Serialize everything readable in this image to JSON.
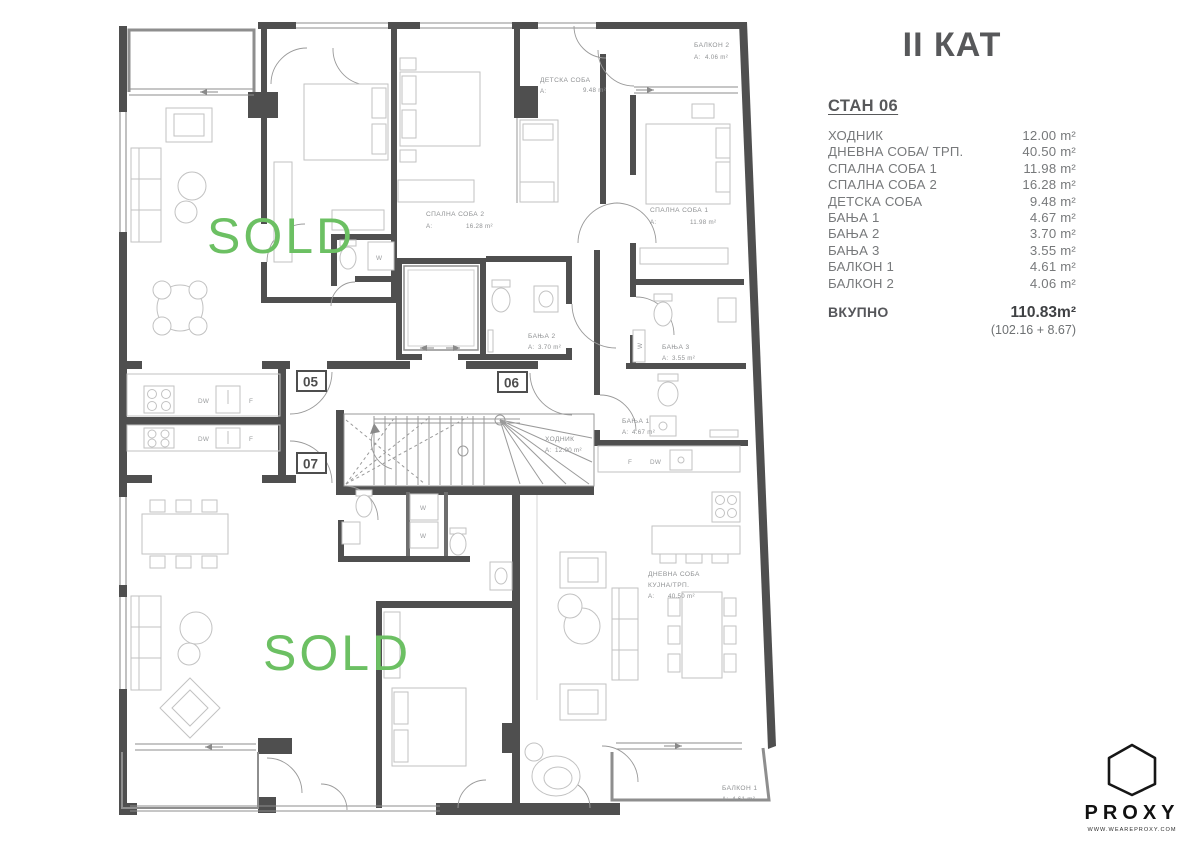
{
  "panel": {
    "floor_title": "II КАТ",
    "apartment_title": "СТАН 06",
    "rooms": [
      {
        "label": "ХОДНИК",
        "value": "12.00 m²"
      },
      {
        "label": "ДНЕВНА СОБА/ ТРП.",
        "value": "40.50 m²"
      },
      {
        "label": "СПАЛНА СОБА 1",
        "value": "11.98 m²"
      },
      {
        "label": "СПАЛНА СОБА 2",
        "value": "16.28 m²"
      },
      {
        "label": "ДЕТСКА СОБА",
        "value": "9.48 m²"
      },
      {
        "label": "БАЊА 1",
        "value": "4.67 m²"
      },
      {
        "label": "БАЊА 2",
        "value": "3.70 m²"
      },
      {
        "label": "БАЊА 3",
        "value": "3.55 m²"
      },
      {
        "label": "БАЛКОН 1",
        "value": "4.61 m²"
      },
      {
        "label": "БАЛКОН 2",
        "value": "4.06 m²"
      }
    ],
    "total_label": "ВКУПНО",
    "total_value": "110.83m²",
    "total_note": "(102.16 + 8.67)"
  },
  "plan": {
    "sold": "SOLD",
    "units": {
      "u05": "05",
      "u06": "06",
      "u07": "07"
    },
    "labels": [
      {
        "name": "БАЛКОН 2",
        "a": "A:",
        "value": "4.06 m²"
      },
      {
        "name": "ДЕТСКА СОБА",
        "a": "A:",
        "value": "9.48 m²"
      },
      {
        "name": "СПАЛНА СОБА 2",
        "a": "A:",
        "value": "16.28 m²"
      },
      {
        "name": "СПАЛНА СОБА 1",
        "a": "A:",
        "value": "11.98 m²"
      },
      {
        "name": "БАЊА 2",
        "a": "A:",
        "value": "3.70 m²"
      },
      {
        "name": "БАЊА 3",
        "a": "A:",
        "value": "3.55 m²"
      },
      {
        "name": "БАЊА 1",
        "a": "A:",
        "value": "4.67 m²"
      },
      {
        "name": "ХОДНИК",
        "a": "A:",
        "value": "12.00 m²"
      },
      {
        "name": "ДНЕВНА СОБА",
        "name2": "КУЈНА/ТРП.",
        "a": "A:",
        "value": "40.50 m²"
      },
      {
        "name": "БАЛКОН 1",
        "a": "A:",
        "value": "4.61 m²"
      }
    ],
    "appliances": {
      "dw": "DW",
      "fridge": "F",
      "washer": "W"
    }
  },
  "branding": {
    "logo": "PROXY",
    "website": "WWW.WEAREPROXY.COM"
  }
}
